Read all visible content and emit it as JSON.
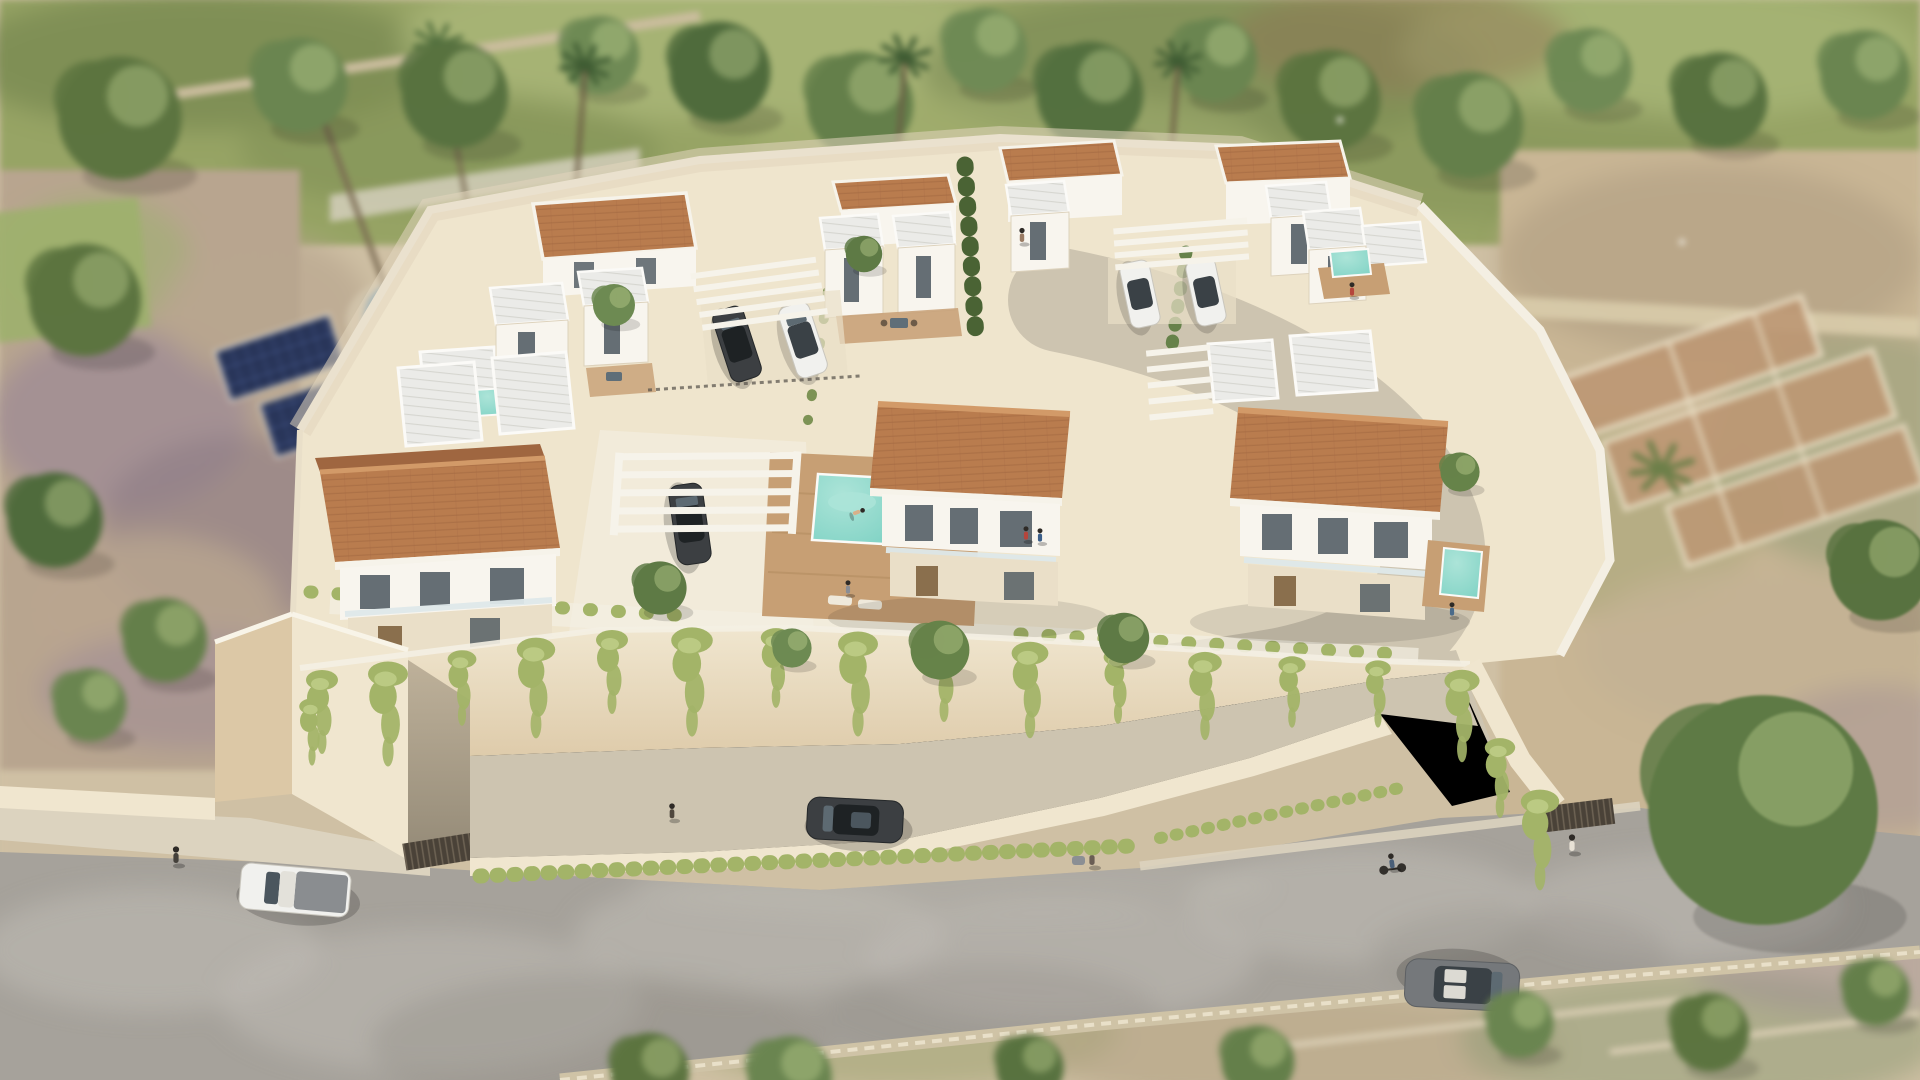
{
  "meta": {
    "title": "Aerial 3D architectural rendering of a gated villa development",
    "media_type": "3D render / architectural visualization",
    "camera": "high-angle aerial view with tilt-shift depth of field",
    "time_of_day": "midday sunlight",
    "visible_text": "none"
  },
  "palette": {
    "field-green": "#97a465",
    "field-green-dark": "#71824d",
    "field-green-light": "#b2bf82",
    "foliage": "#66824a",
    "foliage-dark": "#4a6334",
    "foliage-light": "#8aa468",
    "ground-sand": "#cfc0a4",
    "ground-sand-light": "#e2d6bd",
    "scrub-tan": "#c9b695",
    "stone-terrace": "#bd9774",
    "stone-line": "#e8dcc2",
    "shadow-mauve": "#9b8795",
    "lawn-green": "#9db06d",
    "pool-blue": "#5d8fb3",
    "solar-navy": "#243052",
    "solar-grid": "#50639b",
    "platform-cream": "#efe5cd",
    "pavement-white": "#f4efe3",
    "wall-front": "#f0e6cf",
    "wall-shade": "#dcc8a6",
    "wall-deep": "#c6ae8a",
    "vine-green": "#a3b468",
    "vine-light": "#c0cf8a",
    "road-greige": "#cdc4b0",
    "asphalt": "#a6a29b",
    "asphalt-light": "#c0bcb5",
    "asphalt-dark": "#8f8b84",
    "sidewalk": "#dcd3bf",
    "curb": "#cfc3a6",
    "roof-terracotta": "#b97c4e",
    "roof-terracotta-light": "#d29a68",
    "roof-terracotta-dark": "#9f6640",
    "roof-white": "#ebebe8",
    "roof-rib": "#d6d6d0",
    "villa-white": "#f8f5ee",
    "villa-cream": "#eadfc8",
    "villa-shadow": "#d8cab0",
    "glass-dark": "#4b565e",
    "wood-door": "#8a6f4d",
    "wood-deck": "#c79f74",
    "wood-deck-dark": "#b08a5e",
    "pool-turquoise": "#7fd2c4",
    "pool-turquoise-light": "#ace4d8",
    "pergola-white": "#f6f3ea",
    "car-dark": "#3c3f42",
    "car-white": "#f1f1ee",
    "car-grey": "#75787b",
    "gate-dark": "#4a4238"
  },
  "scene": {
    "setting": {
      "north": "Tree line and mottled green field behind the estate",
      "west": "Neighbouring garden with lawn, palm trees, blue pool and ground-mounted solar panels",
      "east": "Dry scrubland with old stone terrace ruins and a large round tree",
      "south": "Asphalt road, stone kerb and farm plots with low stone walls"
    },
    "estate": {
      "label": "Walled hillside development of white Mediterranean villas",
      "wall_label": "Cream retaining wall draped with hanging vines",
      "villas": [
        {
          "id": "front-left",
          "label": "Front-left villa — gabled terracotta roof, two storeys, balcony"
        },
        {
          "id": "front-center",
          "label": "Front-center villa — gabled terracotta roof with pool terrace"
        },
        {
          "id": "front-right",
          "label": "Front-right villa — gabled terracotta roof with plunge pool"
        },
        {
          "id": "rear-left",
          "label": "Rear-left villa — flat terracotta roof and white stair towers"
        },
        {
          "id": "rear-left-twin",
          "label": "Rear-left twin unit — white volumes with ribbed flat roofs"
        },
        {
          "id": "rear-center",
          "label": "Rear-center villas — roof terraces and cypress hedge court"
        },
        {
          "id": "rear-right",
          "label": "Rear-right villa — flat terracotta roof and carport pergola"
        },
        {
          "id": "rear-right-twin",
          "label": "Rear-right twin unit — flat terracotta roof"
        },
        {
          "id": "east-unit",
          "label": "East villa — white volumes with rooftop plunge pool"
        }
      ],
      "amenities": [
        "White slatted pergola carports",
        "Courtyard swimming pool with timber deck and loungers",
        "Two plunge pools",
        "Underground garage ramp with dark entry gate",
        "East pedestrian gate",
        "Vine-draped retaining walls and landscaped hedges"
      ]
    },
    "pools": [
      {
        "id": "neighbor-pool",
        "label": "Neighbouring garden pool",
        "color": "pool-blue"
      },
      {
        "id": "courtyard-pool",
        "label": "Courtyard swimming pool with swimmer",
        "color": "pool-turquoise"
      },
      {
        "id": "plunge-pool-right",
        "label": "Front-right villa plunge pool",
        "color": "pool-turquoise"
      },
      {
        "id": "plunge-pool-east",
        "label": "East villa plunge pool",
        "color": "pool-turquoise"
      }
    ],
    "vehicles": [
      {
        "id": "car-dark-rear",
        "label": "Dark car parked by the rear-left villas",
        "color": "car-dark"
      },
      {
        "id": "car-white-rear",
        "label": "White car parked by the rear-left villas",
        "color": "car-white"
      },
      {
        "id": "car-dark-pergola",
        "label": "Dark car under the front pergola carport",
        "color": "car-dark"
      },
      {
        "id": "car-white-right-1",
        "label": "White car parked by the rear-right villas",
        "color": "car-white"
      },
      {
        "id": "car-white-right-2",
        "label": "Second white car by the rear-right villas",
        "color": "car-white"
      },
      {
        "id": "suv-white",
        "label": "White SUV on the internal driveway",
        "color": "car-white"
      },
      {
        "id": "car-dark-service",
        "label": "Dark car on the lower service road",
        "color": "car-dark"
      },
      {
        "id": "pickup-white",
        "label": "White pickup truck on the main road",
        "color": "car-white"
      },
      {
        "id": "car-grey-road",
        "label": "Grey car with open sunroof on the main road",
        "color": "car-grey"
      }
    ],
    "people": [
      {
        "label": "Swimmer in the courtyard pool"
      },
      {
        "label": "Sunbather on the pool deck"
      },
      {
        "label": "Residents on the front-center balcony"
      },
      {
        "label": "Resident on the front-right terrace"
      },
      {
        "label": "Pedestrian with stroller on the main road"
      },
      {
        "label": "Cyclist on the main road"
      },
      {
        "label": "Pedestrian on the west sidewalk"
      },
      {
        "label": "Pedestrian on the lower service road"
      },
      {
        "label": "Pedestrian at the east entrance gate"
      },
      {
        "label": "Resident on a rear roof terrace"
      }
    ],
    "roads": {
      "main_road": "Asphalt public road along the south boundary",
      "service_road": "Lower service road behind the retaining wall",
      "driveway": "Curved internal driveway",
      "sidewalk": "Stone-edged sidewalk and kerb"
    },
    "vegetation": {
      "tree_row": "Row of leafy trees and palms along the north edge",
      "big_tree": "Large round tree beside the south-east road bend",
      "vines": "Hanging vines along the retaining walls",
      "hedges": "Clipped hedge rows between the villa courts"
    }
  }
}
